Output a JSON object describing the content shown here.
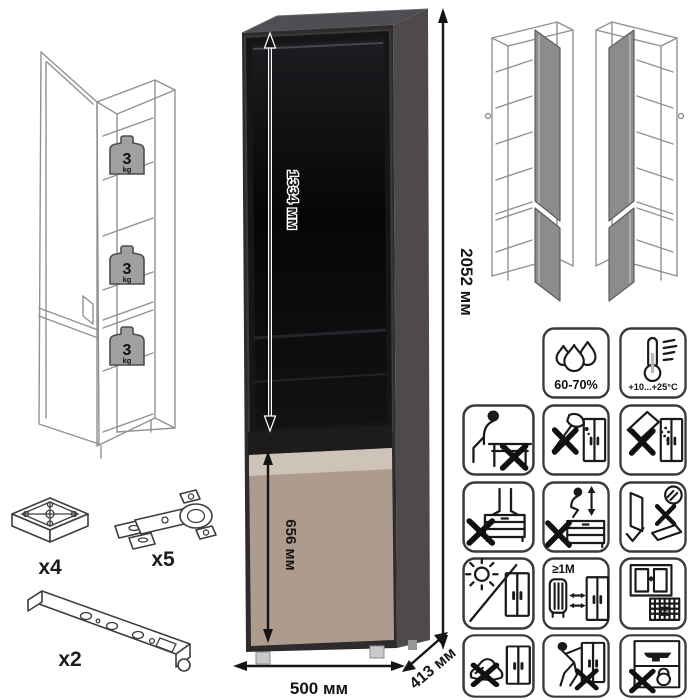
{
  "title": "cabinet-assembly-spec-sheet",
  "dimensions": {
    "total_height": "2052 мм",
    "glass_door_height": "1334 мм",
    "lower_door_height": "656 мм",
    "width": "500 мм",
    "depth": "413 мм"
  },
  "shelf_load": {
    "value": "3",
    "unit": "kg"
  },
  "hardware": {
    "foot_qty": "x4",
    "hinge_qty": "x5",
    "rail_qty": "x2"
  },
  "climate": {
    "humidity_range": "60-70%",
    "temperature_range": "+10...+25°C"
  },
  "care": {
    "min_heater_distance": "≥1М",
    "calendar_day": "21"
  },
  "pictograms": [
    "humidity-tolerance",
    "temperature-range",
    "no-sitting",
    "no-sharp-tools",
    "no-abrasives",
    "no-standing",
    "no-jumping",
    "carry-doors-upright",
    "avoid-direct-sunlight",
    "keep-1m-from-heaters",
    "ventilate-room",
    "no-kicking",
    "no-tipping",
    "no-overloading"
  ],
  "colors": {
    "carcass": "#2e2b2c",
    "side_panel": "#4e4a4b",
    "top_panel": "#504d53",
    "glass": "#0c0c0e",
    "lower_door": "#ad9c8e",
    "lower_door_strip": "#cdc3b8",
    "wireframe_line": "#8e9297",
    "gray_door_panel": "#8c8c8c",
    "weight_badge": "#a0a0a0"
  }
}
